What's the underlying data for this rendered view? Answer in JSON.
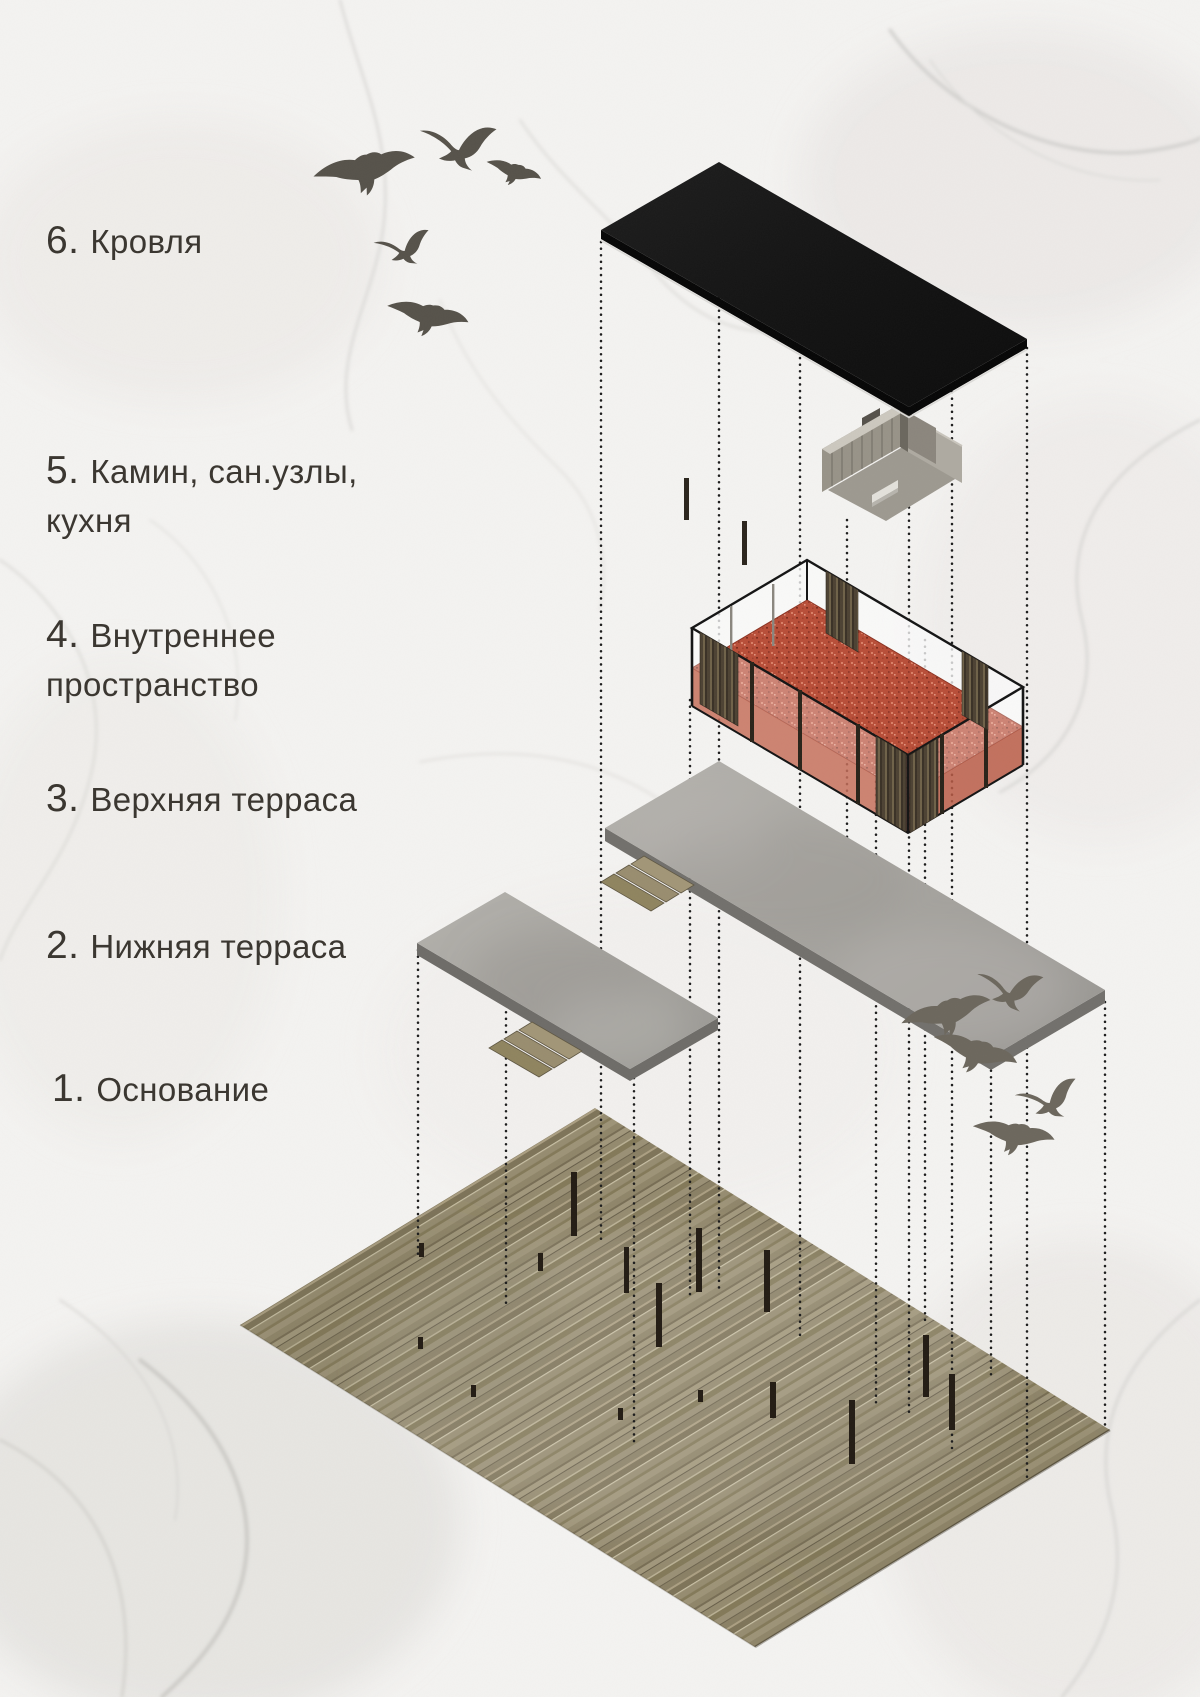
{
  "page": {
    "type": "architectural exploded axonometric poster",
    "language": "ru",
    "background": "white marble texture with gray veins and bird silhouettes"
  },
  "legend": {
    "items": [
      {
        "num": "6.",
        "text": "Кровля"
      },
      {
        "num": "5.",
        "text": "Камин, сан.узлы,\nкухня"
      },
      {
        "num": "4.",
        "text": "Внутреннее\nпространство"
      },
      {
        "num": "3.",
        "text": "Верхняя терраса"
      },
      {
        "num": "2.",
        "text": "Нижняя терраса"
      },
      {
        "num": "1.",
        "text": "Основание"
      }
    ]
  },
  "layers": [
    {
      "id": 6,
      "name": "Кровля",
      "element": "flat black roof slab",
      "color": "#151515"
    },
    {
      "id": 5,
      "name": "Камин, сан.узлы, кухня",
      "element": "gray service core block",
      "color": "#9b968c"
    },
    {
      "id": 4,
      "name": "Внутреннее пространство",
      "element": "glass-walled interior volume with red floor and wood slat panels",
      "color": "#b84e38"
    },
    {
      "id": 3,
      "name": "Верхняя терраса",
      "element": "upper concrete terrace slab with wooden steps",
      "color": "#a9a7a2"
    },
    {
      "id": 2,
      "name": "Нижняя терраса",
      "element": "lower concrete terrace slab with wooden steps",
      "color": "#a9a7a2"
    },
    {
      "id": 1,
      "name": "Основание",
      "element": "wooden deck base with black support columns",
      "color": "#92886c"
    }
  ],
  "decor": {
    "birds_top_left": 5,
    "birds_bottom_right": 5,
    "guide_lines": "vertical dotted projection lines between layers"
  },
  "colors": {
    "background": "#f4f3f1",
    "marble_vein": "#d6d5d2",
    "text": "#3b3731",
    "roof": "#151515",
    "concrete": "#a9a7a2",
    "concrete_edge": "#6e6c68",
    "interior_floor": "#b84e38",
    "glass_frame": "#1a1a1a",
    "wood_slats": "#5a4d3b",
    "deck_wood": "#92886c",
    "columns": "#231c14",
    "steps": "#a29677",
    "birds": "#5f5a52",
    "guide_dots": "#1c1c1c"
  }
}
